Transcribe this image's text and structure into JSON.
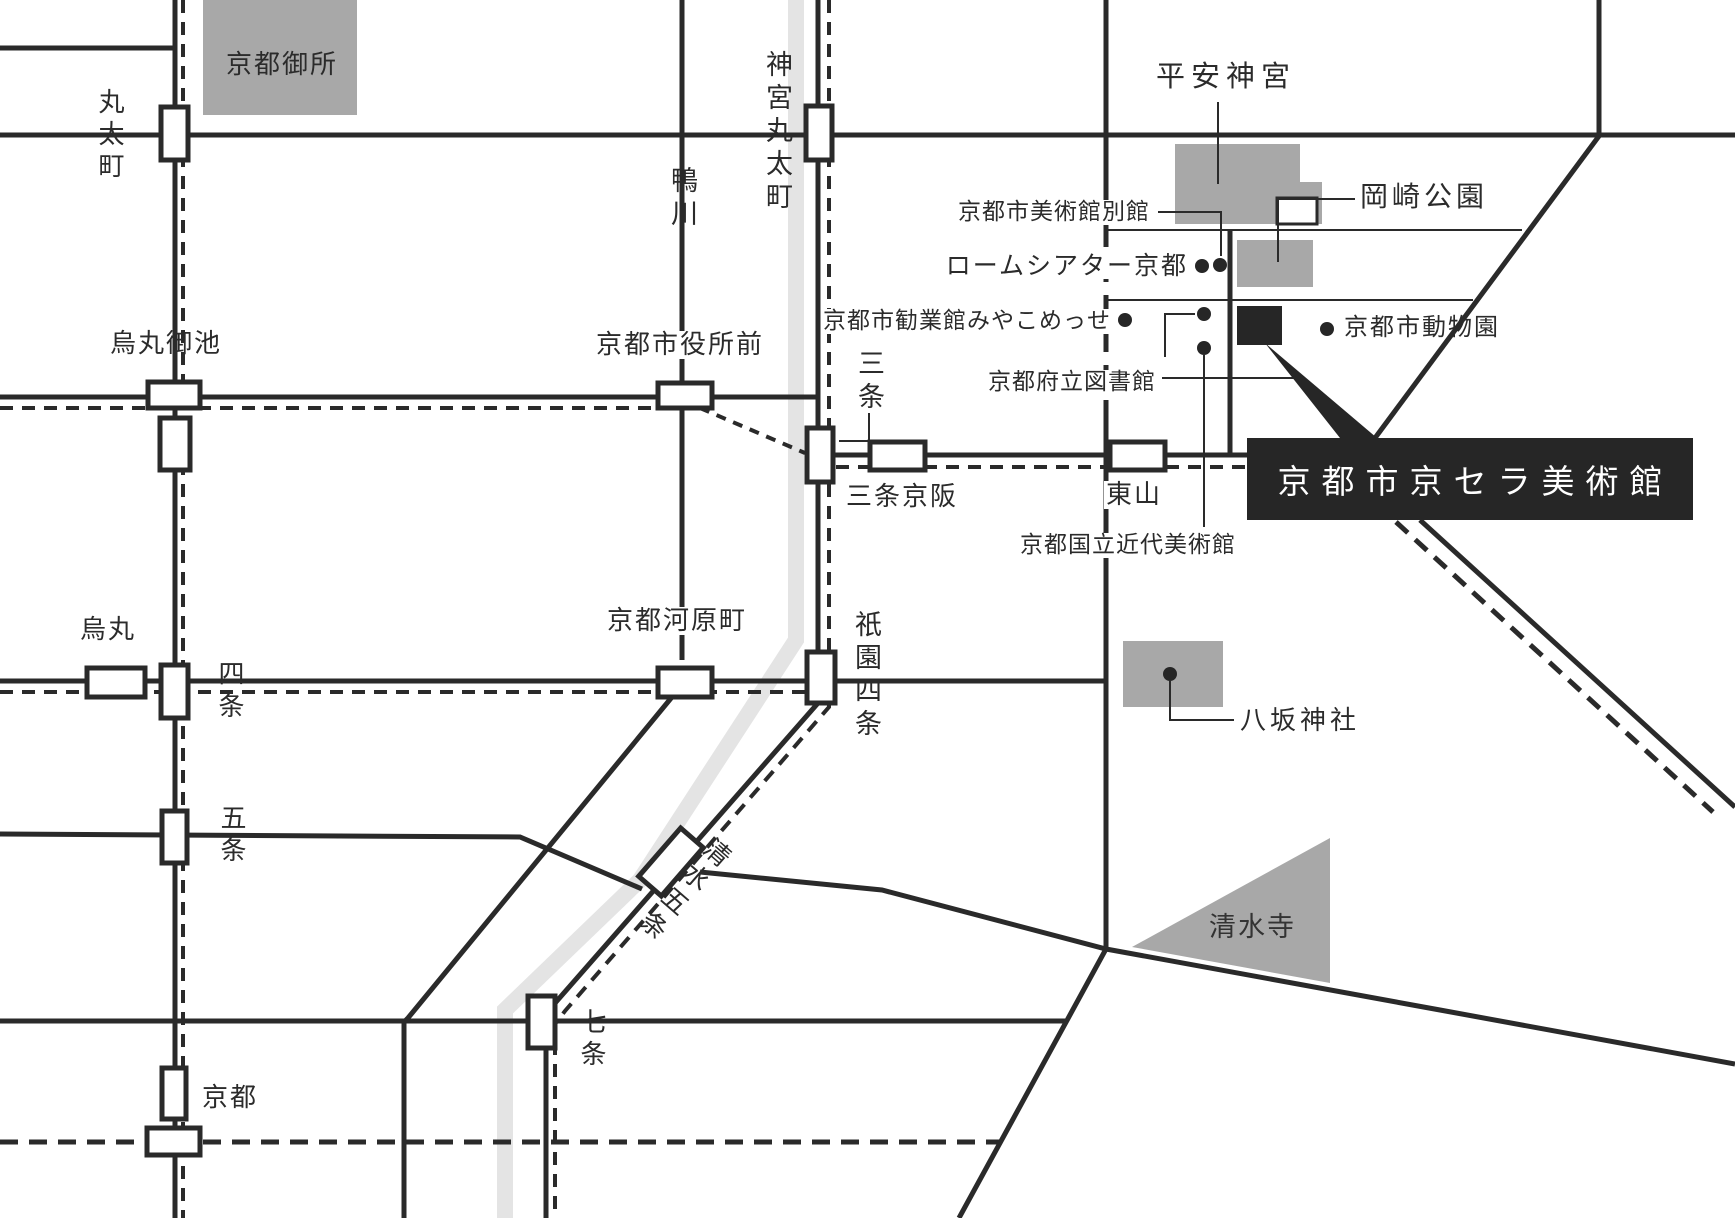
{
  "map_type": "kyoto-access-map",
  "colors": {
    "line_black": "#2a2a2a",
    "landmark_gray": "#a8a8a8",
    "river_gray": "#e4e4e4",
    "museum_black": "#262626",
    "station_fill": "#ffffff"
  },
  "museum": {
    "name": "京都市京セラ美術館"
  },
  "areas": {
    "gosho": "京都御所",
    "heian_jingu": "平安神宮",
    "okazaki_park": "岡崎公園",
    "yasaka_shrine": "八坂神社",
    "kiyomizudera": "清水寺",
    "kamo_river": "鴨川"
  },
  "pois": {
    "bekkan": "京都市美術館別館",
    "rohm_theatre": "ロームシアター京都",
    "miyako_messe": "京都市勧業館みやこめっせ",
    "pref_library": "京都府立図書館",
    "momak": "京都国立近代美術館",
    "zoo": "京都市動物園"
  },
  "stations": {
    "marutamachi": "丸太町",
    "jingu_marutamachi": "神宮丸太町",
    "karasuma_oike": "烏丸御池",
    "shiyakusho_mae": "京都市役所前",
    "sanjo": "三条",
    "sanjo_keihan": "三条京阪",
    "higashiyama": "東山",
    "karasuma": "烏丸",
    "shijo": "四条",
    "kyoto_kawaramachi": "京都河原町",
    "gion_shijo": "祇園四条",
    "gojo": "五条",
    "kiyomizu_gojo": "清水五条",
    "shichijo": "七条",
    "kyoto": "京都"
  }
}
